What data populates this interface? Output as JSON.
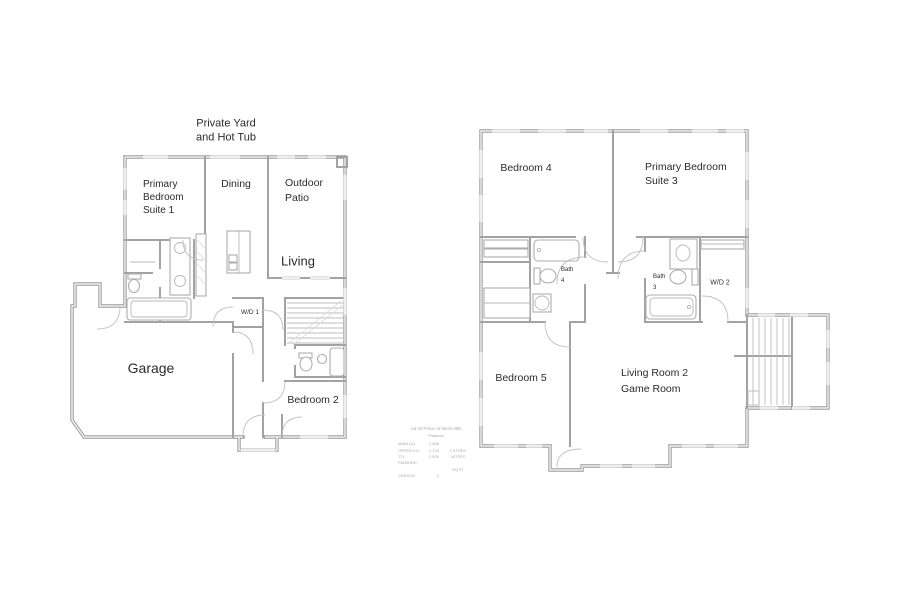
{
  "meta": {
    "background": "#ffffff",
    "wall_color": "#9c9c9c",
    "window_color": "#dcdcdc",
    "text_color": "#2b2b2b",
    "faint_text_color": "#a9a9a9"
  },
  "left_plan": {
    "title": "first-floor-plan",
    "labels": {
      "yard": "Private Yard\nand Hot Tub",
      "primary_suite": "Primary\nBedroom\nSuite 1",
      "dining": "Dining",
      "patio": "Outdoor\nPatio",
      "living": "Living",
      "garage": "Garage",
      "wd": "W/D 1",
      "bedroom2": "Bedroom 2"
    }
  },
  "right_plan": {
    "title": "second-floor-plan",
    "labels": {
      "bedroom4": "Bedroom 4",
      "primary_suite": "Primary Bedroom\nSuite 3",
      "bath4": "Bath\n4",
      "bath3": "Bath\n3",
      "wd": "W/D 2",
      "bedroom5": "Bedroom 5",
      "living": "Living Room 2\nGame Room"
    }
  },
  "title_block": {
    "line1": "Lot 40 Power at Glenn Hills",
    "line2": "Platinum",
    "rows": [
      [
        "MAIN LVL",
        "1,406",
        ""
      ],
      [
        "UPPER LVL",
        "1,133",
        "2 STORY"
      ],
      [
        "TTL FINISHED",
        "2,539",
        "NOTES"
      ],
      [
        "",
        "",
        "SQ FT"
      ],
      [
        "GARAGE",
        "2",
        ""
      ]
    ]
  }
}
